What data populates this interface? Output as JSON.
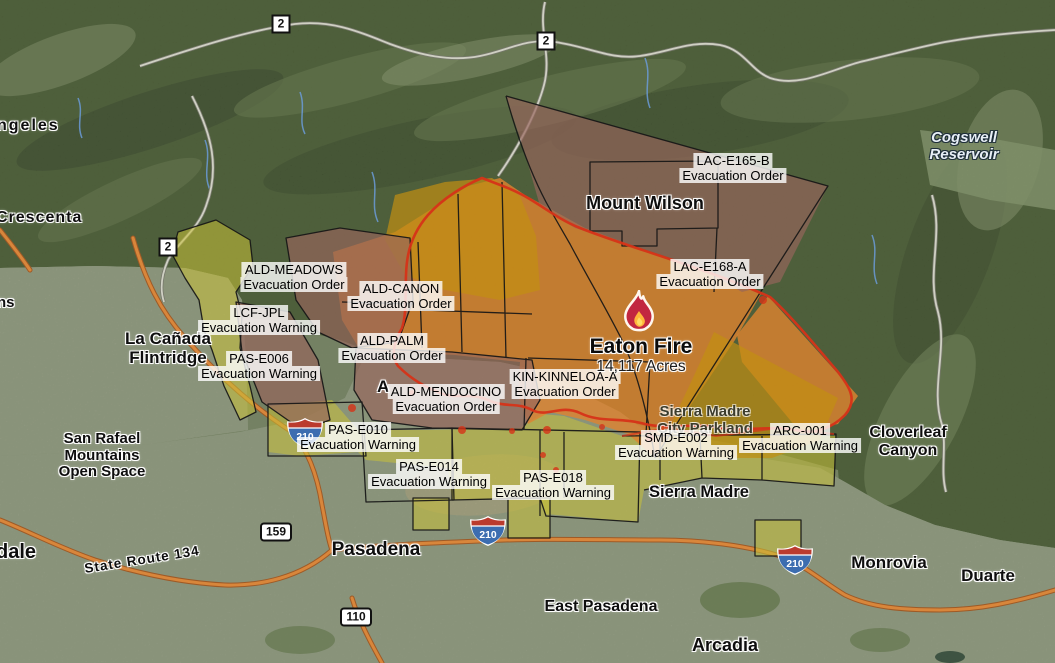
{
  "fire": {
    "name": "Eaton Fire",
    "acres": "14,117 Acres"
  },
  "zone_labels": [
    {
      "name": "ALD-MEADOWS",
      "status": "Evacuation Order"
    },
    {
      "name": "ALD-CANON",
      "status": "Evacuation Order"
    },
    {
      "name": "LCF-JPL",
      "status": "Evacuation Warning"
    },
    {
      "name": "PAS-E006",
      "status": "Evacuation Warning"
    },
    {
      "name": "ALD-PALM",
      "status": "Evacuation Order"
    },
    {
      "name": "ALD-MENDOCINO",
      "status": "Evacuation Order"
    },
    {
      "name": "KIN-KINNELOA-A",
      "status": "Evacuation Order"
    },
    {
      "name": "LAC-E165-B",
      "status": "Evacuation Order"
    },
    {
      "name": "LAC-E168-A",
      "status": "Evacuation Order"
    },
    {
      "name": "PAS-E010",
      "status": "Evacuation Warning"
    },
    {
      "name": "PAS-E014",
      "status": "Evacuation Warning"
    },
    {
      "name": "PAS-E018",
      "status": "Evacuation Warning"
    },
    {
      "name": "SMD-E002",
      "status": "Evacuation Warning"
    },
    {
      "name": "ARC-001",
      "status": "Evacuation Warning"
    }
  ],
  "places": {
    "angeles_partial": "ngeles",
    "crescenta_partial": "Crescenta",
    "mountains_partial": "ns",
    "glendale_partial": "dale",
    "la_canada_line1": "La Cañada",
    "la_canada_line2": "Flintridge",
    "mount_wilson": "Mount Wilson",
    "altadena_partial": "A",
    "san_rafael_line1": "San Rafael",
    "san_rafael_line2": "Mountains",
    "san_rafael_line3": "Open Space",
    "state_route_134": "State Route 134",
    "pasadena": "Pasadena",
    "east_pasadena": "East Pasadena",
    "sierra_madre": "Sierra Madre",
    "parkland_line1": "Sierra Madre",
    "parkland_line2": "City Parkland",
    "arcadia": "Arcadia",
    "monrovia": "Monrovia",
    "duarte": "Duarte",
    "cloverleaf_line1": "Cloverleaf",
    "cloverleaf_line2": "Canyon",
    "cogswell_line1": "Cogswell",
    "cogswell_line2": "Reservoir"
  },
  "shields": {
    "route_2": "2",
    "route_159": "159",
    "route_110": "110",
    "interstate_210": "210"
  },
  "legend_colors": {
    "evacuation_order_zone": "#e0832f",
    "evacuation_warning_zone": "#c8c139",
    "burned_order_zone": "#96655c",
    "fire_area": "#c28f13",
    "fire_perimeter": "#d63318",
    "freeway": "#d8863b"
  }
}
